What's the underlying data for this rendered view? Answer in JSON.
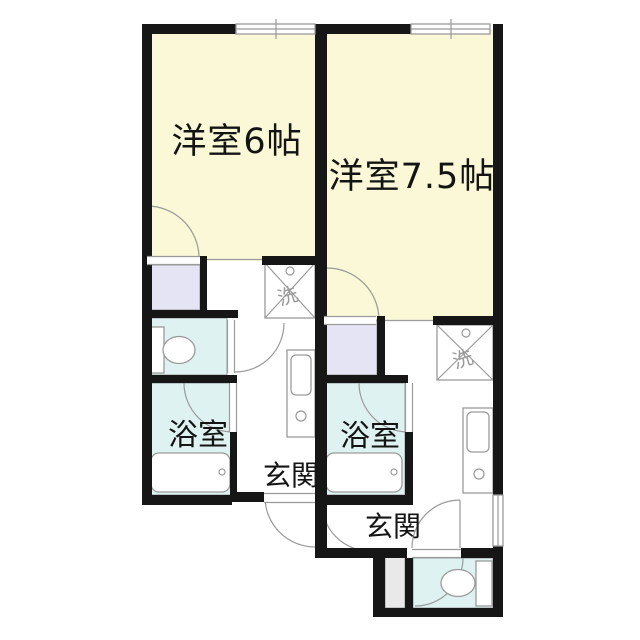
{
  "plan": {
    "unit_a": {
      "room_label": "洋室6帖",
      "bath_label": "浴室",
      "entrance_label": "玄関",
      "washer_label": "洗"
    },
    "unit_b": {
      "room_label": "洋室7.5帖",
      "bath_label": "浴室",
      "entrance_label": "玄関",
      "washer_label": "洗"
    }
  },
  "colors": {
    "wall": "#161616",
    "room_floor": "#FAF8D6",
    "closet": "#E4E4F5",
    "wet_floor": "#DEF3F1",
    "step": "#E9E9E9",
    "line": "#9a9a9a",
    "background": "#ffffff"
  }
}
